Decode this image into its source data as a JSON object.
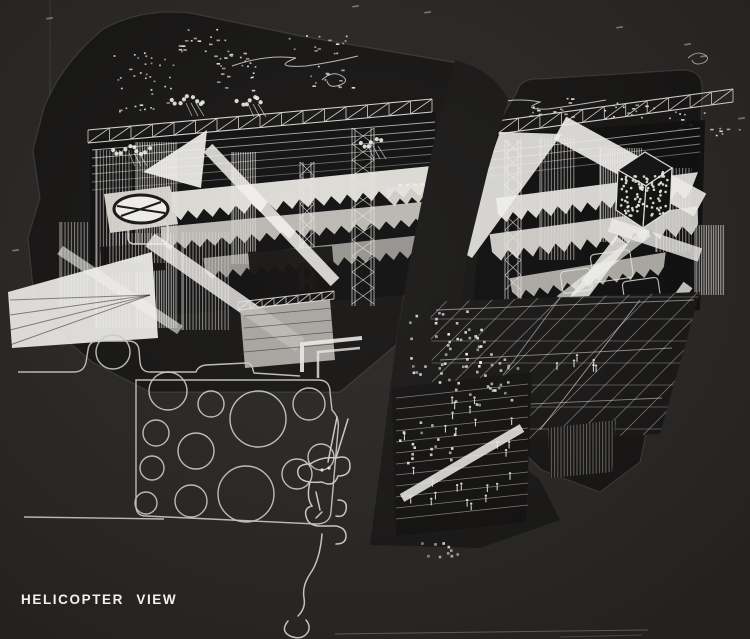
{
  "caption": {
    "label": "HELICOPTER VIEW"
  },
  "colors": {
    "background": "#262422",
    "panel": "#131211",
    "seam": "#161514",
    "ink": "#e8e6e1",
    "bright": "#f4f3ef",
    "dim": "#cfccc6",
    "caption": "#f2f1ee"
  },
  "ground_plan": {
    "circles": [
      [
        113,
        352,
        17
      ],
      [
        168,
        391,
        19
      ],
      [
        211,
        404,
        13
      ],
      [
        258,
        419,
        28
      ],
      [
        309,
        404,
        16
      ],
      [
        156,
        433,
        13
      ],
      [
        196,
        451,
        18
      ],
      [
        152,
        468,
        12
      ],
      [
        246,
        494,
        28
      ],
      [
        297,
        474,
        15
      ],
      [
        146,
        503,
        11
      ],
      [
        191,
        501,
        16
      ],
      [
        321,
        457,
        13
      ]
    ]
  },
  "city_lights": {
    "clusters": [
      {
        "x": 112,
        "y": 52,
        "w": 62,
        "h": 42,
        "n": 26
      },
      {
        "x": 178,
        "y": 28,
        "w": 52,
        "h": 30,
        "n": 18
      },
      {
        "x": 214,
        "y": 52,
        "w": 42,
        "h": 38,
        "n": 24
      },
      {
        "x": 288,
        "y": 34,
        "w": 62,
        "h": 24,
        "n": 14
      },
      {
        "x": 308,
        "y": 64,
        "w": 46,
        "h": 24,
        "n": 12
      },
      {
        "x": 118,
        "y": 94,
        "w": 52,
        "h": 18,
        "n": 10
      },
      {
        "x": 526,
        "y": 96,
        "w": 56,
        "h": 22,
        "n": 14
      },
      {
        "x": 598,
        "y": 101,
        "w": 62,
        "h": 18,
        "n": 16
      },
      {
        "x": 666,
        "y": 110,
        "w": 46,
        "h": 20,
        "n": 12
      },
      {
        "x": 710,
        "y": 126,
        "w": 30,
        "h": 12,
        "n": 6
      }
    ]
  },
  "crowds": {
    "dot_clusters": [
      {
        "x": 406,
        "y": 310,
        "w": 88,
        "h": 66,
        "n": 42
      },
      {
        "x": 438,
        "y": 352,
        "w": 80,
        "h": 52,
        "n": 30
      },
      {
        "x": 398,
        "y": 418,
        "w": 58,
        "h": 48,
        "n": 18
      },
      {
        "x": 420,
        "y": 540,
        "w": 60,
        "h": 16,
        "n": 10
      }
    ],
    "person_clusters": [
      {
        "x": 400,
        "y": 396,
        "w": 112,
        "h": 110,
        "n": 26
      },
      {
        "x": 556,
        "y": 346,
        "w": 42,
        "h": 26,
        "n": 6
      }
    ]
  },
  "light_stalks": [
    {
      "x": 190,
      "y": 100,
      "n": 9
    },
    {
      "x": 133,
      "y": 150,
      "n": 10
    },
    {
      "x": 252,
      "y": 101,
      "n": 7
    },
    {
      "x": 372,
      "y": 143,
      "n": 6
    }
  ],
  "background_specks": [
    [
      352,
      6
    ],
    [
      424,
      12
    ],
    [
      616,
      27
    ],
    [
      684,
      44
    ],
    [
      738,
      118
    ],
    [
      46,
      18
    ],
    [
      12,
      250
    ],
    [
      700,
      56
    ]
  ]
}
